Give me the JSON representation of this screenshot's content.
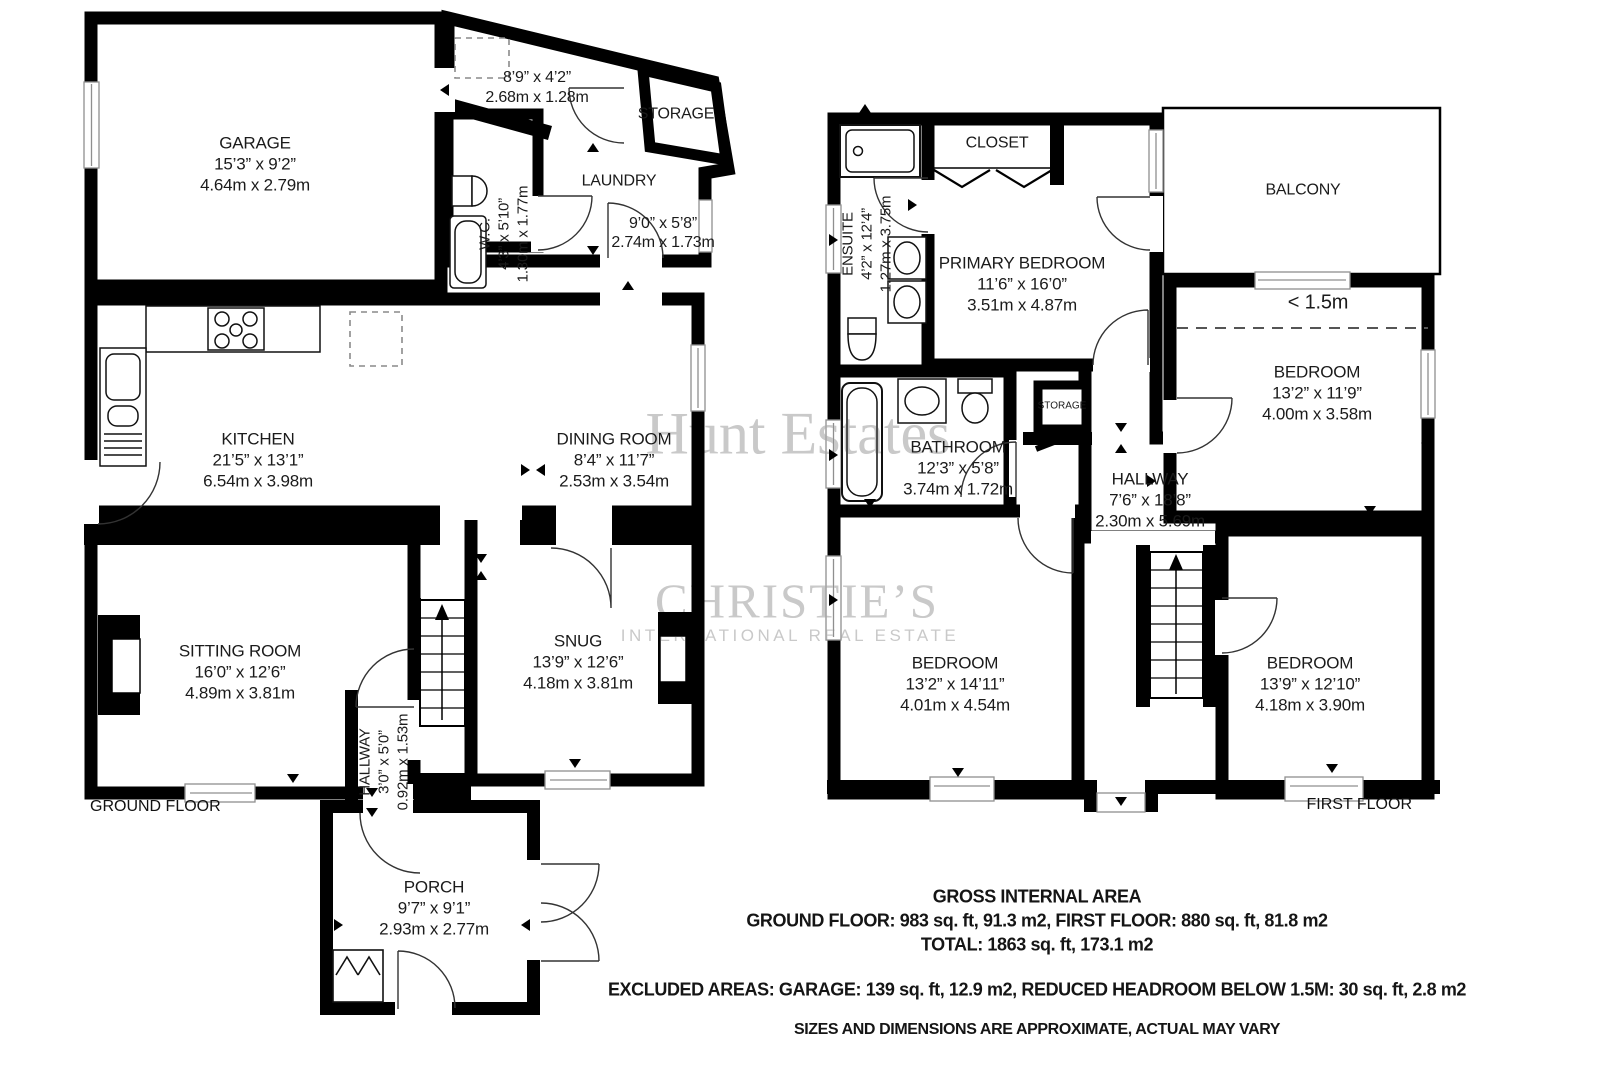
{
  "watermark": {
    "name": "Hunt Estates",
    "brand": "CHRISTIE’S",
    "brand_sub": "INTERNATIONAL REAL ESTATE"
  },
  "floor_labels": {
    "ground": "GROUND FLOOR",
    "first": "FIRST FLOOR"
  },
  "rooms": {
    "garage": {
      "name": "GARAGE",
      "ft": "15’3” x 9’2”",
      "m": "4.64m x 2.79m"
    },
    "laundry_nook": {
      "ft": "8’9” x 4’2”",
      "m": "2.68m x 1.28m"
    },
    "storage_ground": {
      "name": "STORAGE"
    },
    "wc": {
      "name": "W.C.",
      "ft": "4’3” x 5’10”",
      "m": "1.30m x 1.77m"
    },
    "laundry": {
      "name": "LAUNDRY",
      "ft": "9’0” x 5’8”",
      "m": "2.74m x 1.73m"
    },
    "kitchen": {
      "name": "KITCHEN",
      "ft": "21’5” x 13’1”",
      "m": "6.54m x 3.98m"
    },
    "dining": {
      "name": "DINING ROOM",
      "ft": "8’4” x 11’7”",
      "m": "2.53m x 3.54m"
    },
    "sitting": {
      "name": "SITTING ROOM",
      "ft": "16’0” x 12’6”",
      "m": "4.89m x 3.81m"
    },
    "snug": {
      "name": "SNUG",
      "ft": "13’9” x 12’6”",
      "m": "4.18m x 3.81m"
    },
    "hallway_ground": {
      "name": "HALLWAY",
      "ft": "3’0” x 5’0”",
      "m": "0.92m x 1.53m"
    },
    "porch": {
      "name": "PORCH",
      "ft": "9’7” x 9’1”",
      "m": "2.93m x 2.77m"
    },
    "ensuite": {
      "name": "ENSUITE",
      "ft": "4’2” x 12’4”",
      "m": "1.27m x 3.75m"
    },
    "closet": {
      "name": "CLOSET"
    },
    "primary_bedroom": {
      "name": "PRIMARY BEDROOM",
      "ft": "11’6” x 16’0”",
      "m": "3.51m x 4.87m"
    },
    "balcony": {
      "name": "BALCONY"
    },
    "bedroom_top_right": {
      "name": "BEDROOM",
      "ft": "13’2” x 11’9”",
      "m": "4.00m x 3.58m"
    },
    "bathroom": {
      "name": "BATHROOM",
      "ft": "12’3” x 5’8”",
      "m": "3.74m x 1.72m"
    },
    "storage_first": {
      "name": "STORAGE"
    },
    "hallway_first": {
      "name": "HALLWAY",
      "ft": "7’6” x 18’8”",
      "m": "2.30m x 5.69m"
    },
    "bedroom_bottom_left": {
      "name": "BEDROOM",
      "ft": "13’2” x 14’11”",
      "m": "4.01m x 4.54m"
    },
    "bedroom_bottom_right": {
      "name": "BEDROOM",
      "ft": "13’9” x 12’10”",
      "m": "4.18m x 3.90m"
    }
  },
  "annotations": {
    "reduced_headroom": "< 1.5m"
  },
  "footer": {
    "title": "GROSS INTERNAL AREA",
    "areas_line": "GROUND FLOOR: 983 sq. ft, 91.3 m2, FIRST FLOOR: 880 sq. ft, 81.8 m2",
    "total_line": "TOTAL: 1863 sq. ft, 173.1 m2",
    "excluded_line": "EXCLUDED AREAS: GARAGE: 139 sq. ft, 12.9 m2, REDUCED HEADROOM BELOW 1.5M: 30 sq. ft, 2.8 m2",
    "disclaimer": "SIZES AND DIMENSIONS ARE APPROXIMATE, ACTUAL MAY VARY"
  }
}
